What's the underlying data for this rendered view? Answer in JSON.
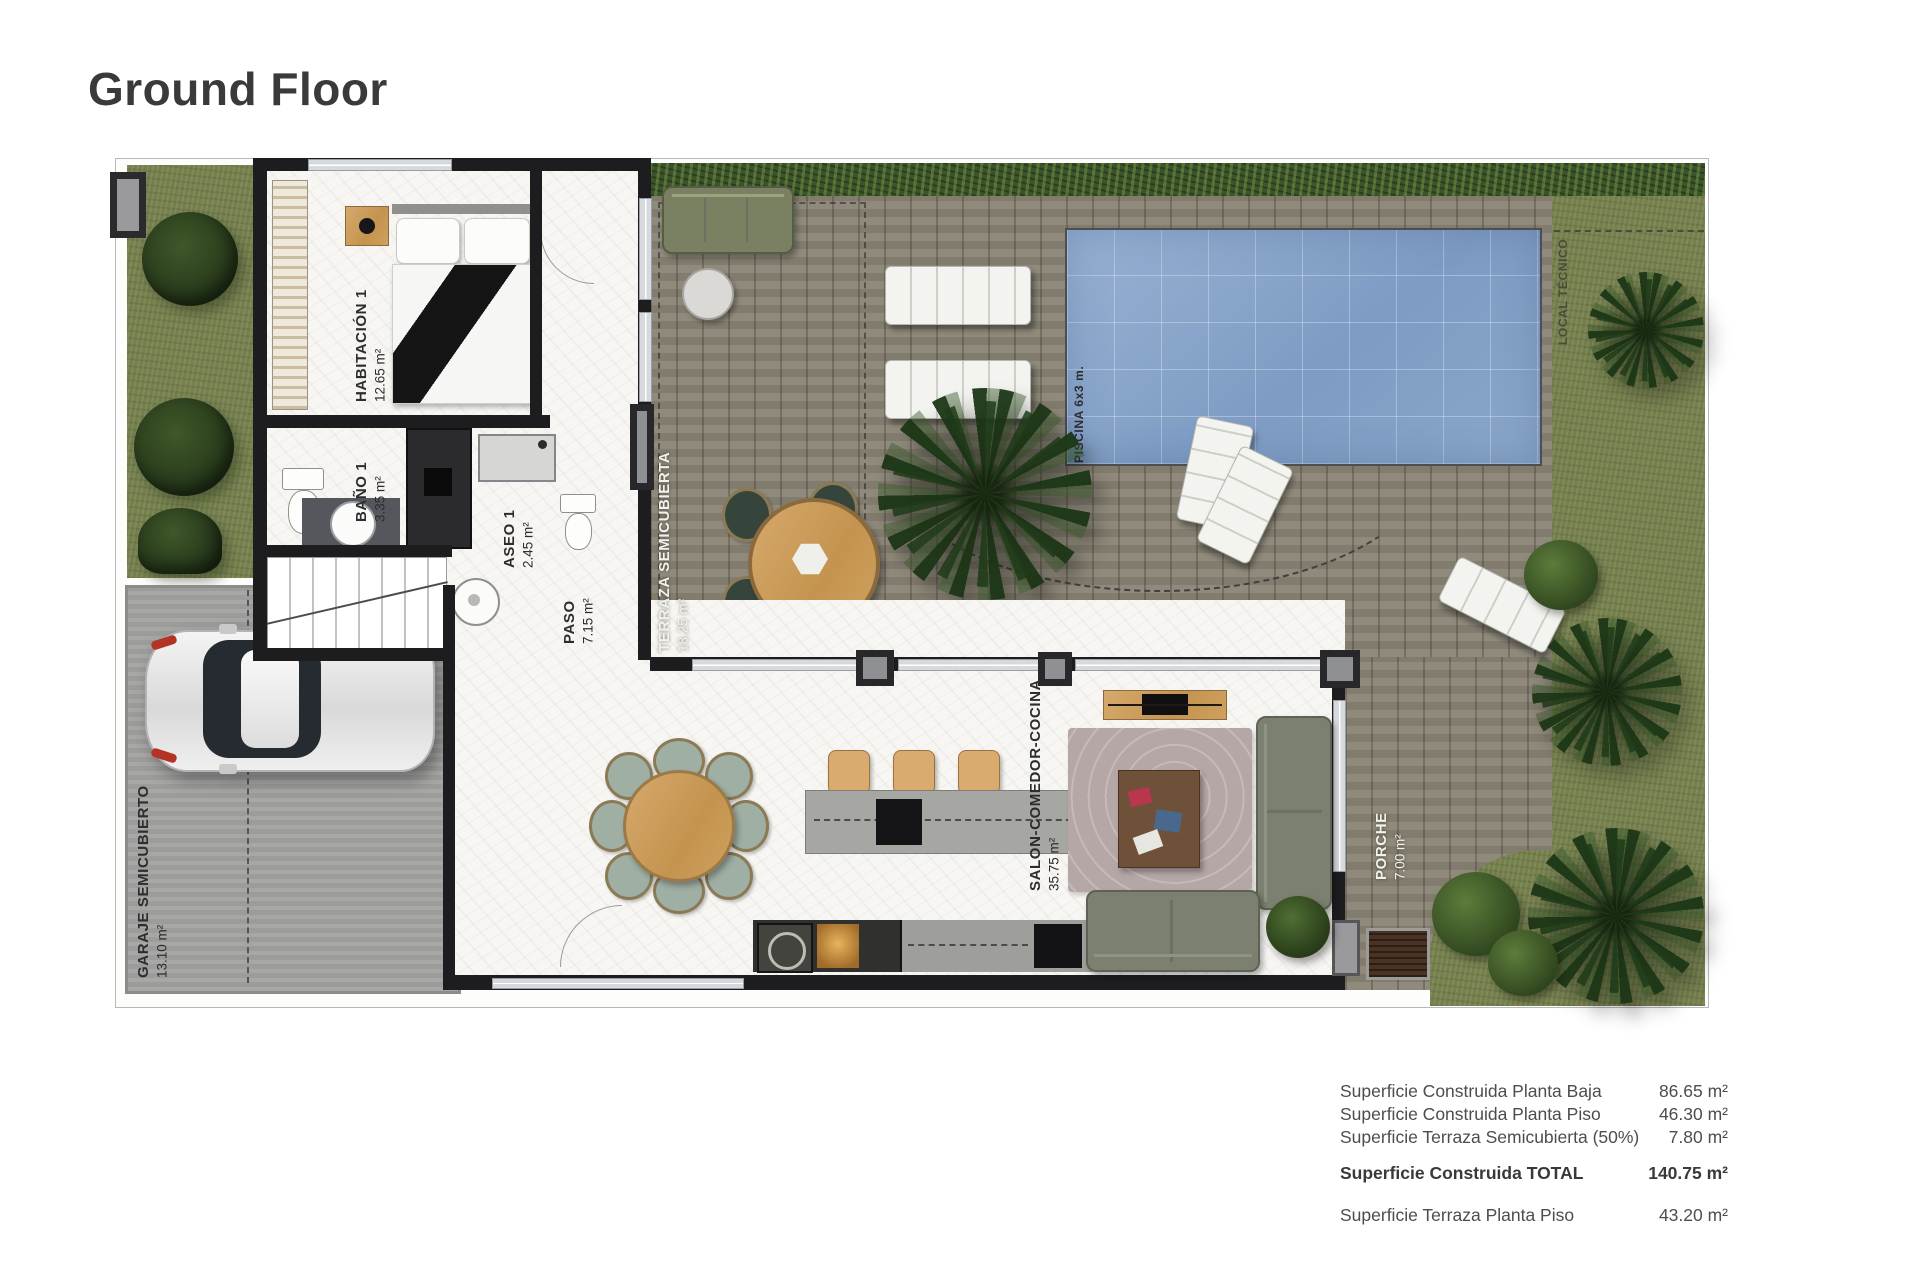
{
  "page": {
    "title": "Ground Floor"
  },
  "plan": {
    "rooms": [
      {
        "id": "habitacion-1",
        "label": "HABITACIÓN 1",
        "area": "12.65 m²"
      },
      {
        "id": "bano-1",
        "label": "BAÑO 1",
        "area": "3.35 m²"
      },
      {
        "id": "aseo-1",
        "label": "ASEO 1",
        "area": "2.45 m²"
      },
      {
        "id": "paso",
        "label": "PASO",
        "area": "7.15 m²"
      },
      {
        "id": "terraza",
        "label": "TERRAZA SEMICUBIERTA",
        "area": "18.25 m²"
      },
      {
        "id": "salon",
        "label": "SALON-COMEDOR-COCINA",
        "area": "35.75 m²"
      },
      {
        "id": "garaje",
        "label": "GARAJE SEMICUBIERTO",
        "area": "13.10 m²"
      },
      {
        "id": "porche",
        "label": "PORCHE",
        "area": "7.00 m²"
      },
      {
        "id": "piscina",
        "label": "PISCINA 6x3 m."
      },
      {
        "id": "local-tecnico",
        "label": "LOCAL TÉCNICO"
      }
    ]
  },
  "summary": {
    "rows": [
      {
        "label": "Superficie Construida Planta Baja",
        "value": "86.65 m²"
      },
      {
        "label": "Superficie Construida Planta Piso",
        "value": "46.30 m²"
      },
      {
        "label": "Superficie Terraza Semicubierta (50%)",
        "value": "7.80 m²"
      },
      {
        "label": "Superficie Construida TOTAL",
        "value": "140.75 m²"
      },
      {
        "label": "Superficie Terraza Planta Piso",
        "value": "43.20 m²"
      }
    ]
  },
  "colors": {
    "title": "#3a3a3c",
    "wall": "#1d1d1f",
    "pool": "#7e9cc4",
    "deck": "#8a8475",
    "grass": "#75804d",
    "hedge": "#3c5429",
    "garage": "#a2a2a1",
    "marble": "#f7f6f3"
  }
}
